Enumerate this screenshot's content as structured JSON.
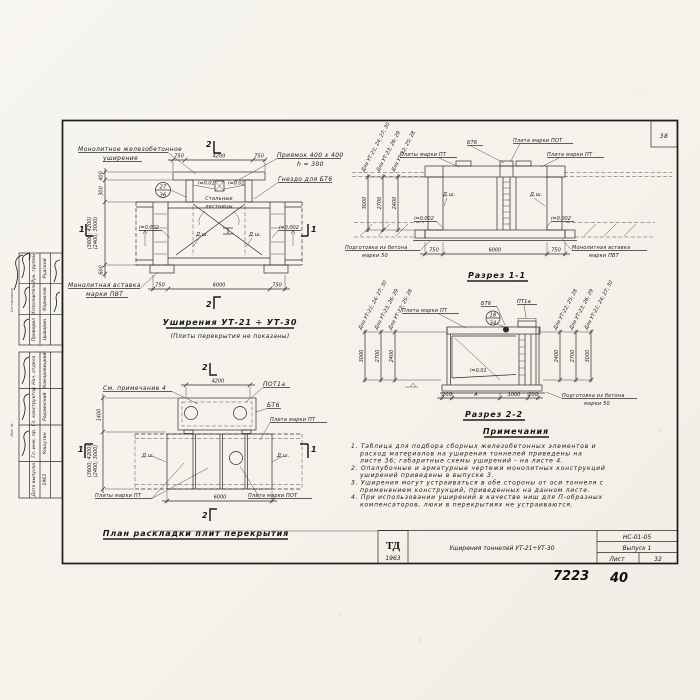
{
  "sheet": {
    "corner_number": "38",
    "hand_number_1": "7223",
    "hand_number_2": "40"
  },
  "titleblock": {
    "logo_top": "ТД",
    "logo_year": "1963",
    "title": "Уширения тоннелей УТ-21÷УТ-30",
    "doc_code": "НС-01-05",
    "issue": "Выпуск 1",
    "sheet_label": "Лист",
    "sheet_number": "32"
  },
  "margin_stamp": {
    "top_rows": [
      {
        "role": "Рук. группы",
        "name": "Рудской"
      },
      {
        "role": "Исполнитель",
        "name": "Корнилов"
      },
      {
        "role": "Проверил",
        "name": "Цыварин"
      }
    ],
    "bottom_rows": [
      {
        "role": "Нач. отдела",
        "name": "Комаровицкий"
      },
      {
        "role": "Гл. конструктор",
        "name": "Радзинский"
      },
      {
        "role": "Гл. инж. пр.",
        "name": "Кошутин"
      },
      {
        "role": "Дата выпуска",
        "name": "1963"
      }
    ],
    "edge_labels": [
      "Согласовано",
      "Инв. №"
    ]
  },
  "elevation": {
    "callout_widening_1": "Монолитное железобетонное",
    "callout_widening_2": "уширение",
    "callout_pit_1": "Приямок 400 x 400",
    "callout_pit_2": "h = 300",
    "callout_socket": "Гнездо для БТ6",
    "callout_stairs_1": "Стальные",
    "callout_stairs_2": "лестницы",
    "callout_insert_1": "Монолитная вставка",
    "callout_insert_2": "марки ПВТ",
    "detail_num": "27",
    "detail_sheet": "36",
    "joint_left": "Д.ш.",
    "joint_right": "Д.ш.",
    "slope_left": "i=0.002",
    "slope_right": "i=0.002",
    "slope_pit_left": "i=0.01",
    "slope_pit_right": "i=0.01",
    "dim_top_left": "750",
    "dim_top_mid": "4200",
    "dim_top_right": "750",
    "dim_bot_left": "750",
    "dim_bot_mid": "6000",
    "dim_bot_right": "750",
    "dim_v1": "400",
    "dim_v2": "300",
    "dim_v3a": "(2400; 3000)",
    "dim_v3b": "(3600; 4200)",
    "dim_v4": "600",
    "mark_2_top": "2",
    "mark_2_bot": "2",
    "mark_1_left": "1",
    "mark_1_right": "1",
    "title": "Уширения УТ-21 ÷ УТ-30",
    "subtitle": "(Плиты перекрытия не показаны)"
  },
  "plan": {
    "callout_note": "См. примечание 4",
    "callout_pot1a": "ПОТ1а",
    "callout_bt6": "БТ6",
    "callout_pt_right": "Плита марки ПТ",
    "callout_pt_bottom": "Плиты марки ПТ",
    "callout_pot_bottom": "Плита марки ПОТ",
    "joint_left": "Д.ш.",
    "joint_right": "Д.ш.",
    "dim_top": "4200",
    "dim_bottom": "6000",
    "dim_v1": "1400",
    "dim_v2a": "(2400; 3000)",
    "dim_v2b": "(3600; 4200)",
    "mark_2_top": "2",
    "mark_2_bot": "2",
    "mark_1_left": "1",
    "mark_1_right": "1",
    "title": "План раскладки плит перекрытия"
  },
  "section1": {
    "title": "Разрез 1-1",
    "callout_bt6": "БТ6",
    "callout_pot": "Плита марки ПОТ",
    "callout_pt_left": "Плиты марки ПТ",
    "callout_pt_right": "Плита марки ПТ",
    "callout_prep_1": "Подготовка из бетона",
    "callout_prep_2": "марки 50",
    "callout_insert_1": "Монолитная вставка",
    "callout_insert_2": "марки ПВТ",
    "joint_left": "Д.ш.",
    "joint_right": "Д.ш.",
    "slope_left": "i=0.002",
    "slope_right": "i=0.002",
    "dim_bot_left": "750",
    "dim_bot_mid": "6000",
    "dim_bot_right": "750",
    "rot_labels": [
      "Для УТ-21; 24; 27; 30",
      "Для УТ-23; 26; 29",
      "Для УТ-22; 25; 28"
    ],
    "rot_values": [
      "3000",
      "2700",
      "2400"
    ]
  },
  "section2": {
    "title": "Разрез 2-2",
    "callout_pt": "Плита марки ПТ",
    "callout_bt6": "БТ6",
    "callout_pt1a": "ПТ1а",
    "detail_num": "18",
    "detail_sheet": "34",
    "slope": "i=0.01",
    "callout_prep_1": "Подготовка из бетона",
    "callout_prep_2": "марки 50",
    "dim_1": "200",
    "dim_2": "А",
    "dim_3": "1000",
    "dim_4": "200",
    "rot_labels_left": [
      "Для УТ-21; 24; 27; 30",
      "Для УТ-23; 26; 29",
      "Для УТ-22; 25; 28"
    ],
    "rot_values_left": [
      "3000",
      "2700",
      "2400"
    ],
    "rot_labels_right": [
      "Для УТ-22; 25; 28",
      "Для УТ-23; 26; 29",
      "Для УТ-21; 24; 27; 30"
    ],
    "rot_values_right": [
      "2400",
      "2700",
      "3000"
    ]
  },
  "notes": {
    "header": "Примечания",
    "lines": [
      "1. Таблица для подбора сборных железобетонных элементов и",
      "расход материалов на уширения тоннелей приведены на",
      "листе 36; габаритные схемы уширений - на листе 4.",
      "2. Опалубочные и арматурные чертежи монолитных конструкций",
      "уширений приведены в выпуске 3.",
      "3. Уширения могут устраиваться в обе стороны от оси тоннеля с",
      "применением конструкций, приведенных на данном листе.",
      "4. При использовании уширений в качестве ниш для П-образных",
      "компенсаторов, люки в перекрытиях не устраиваются."
    ]
  }
}
